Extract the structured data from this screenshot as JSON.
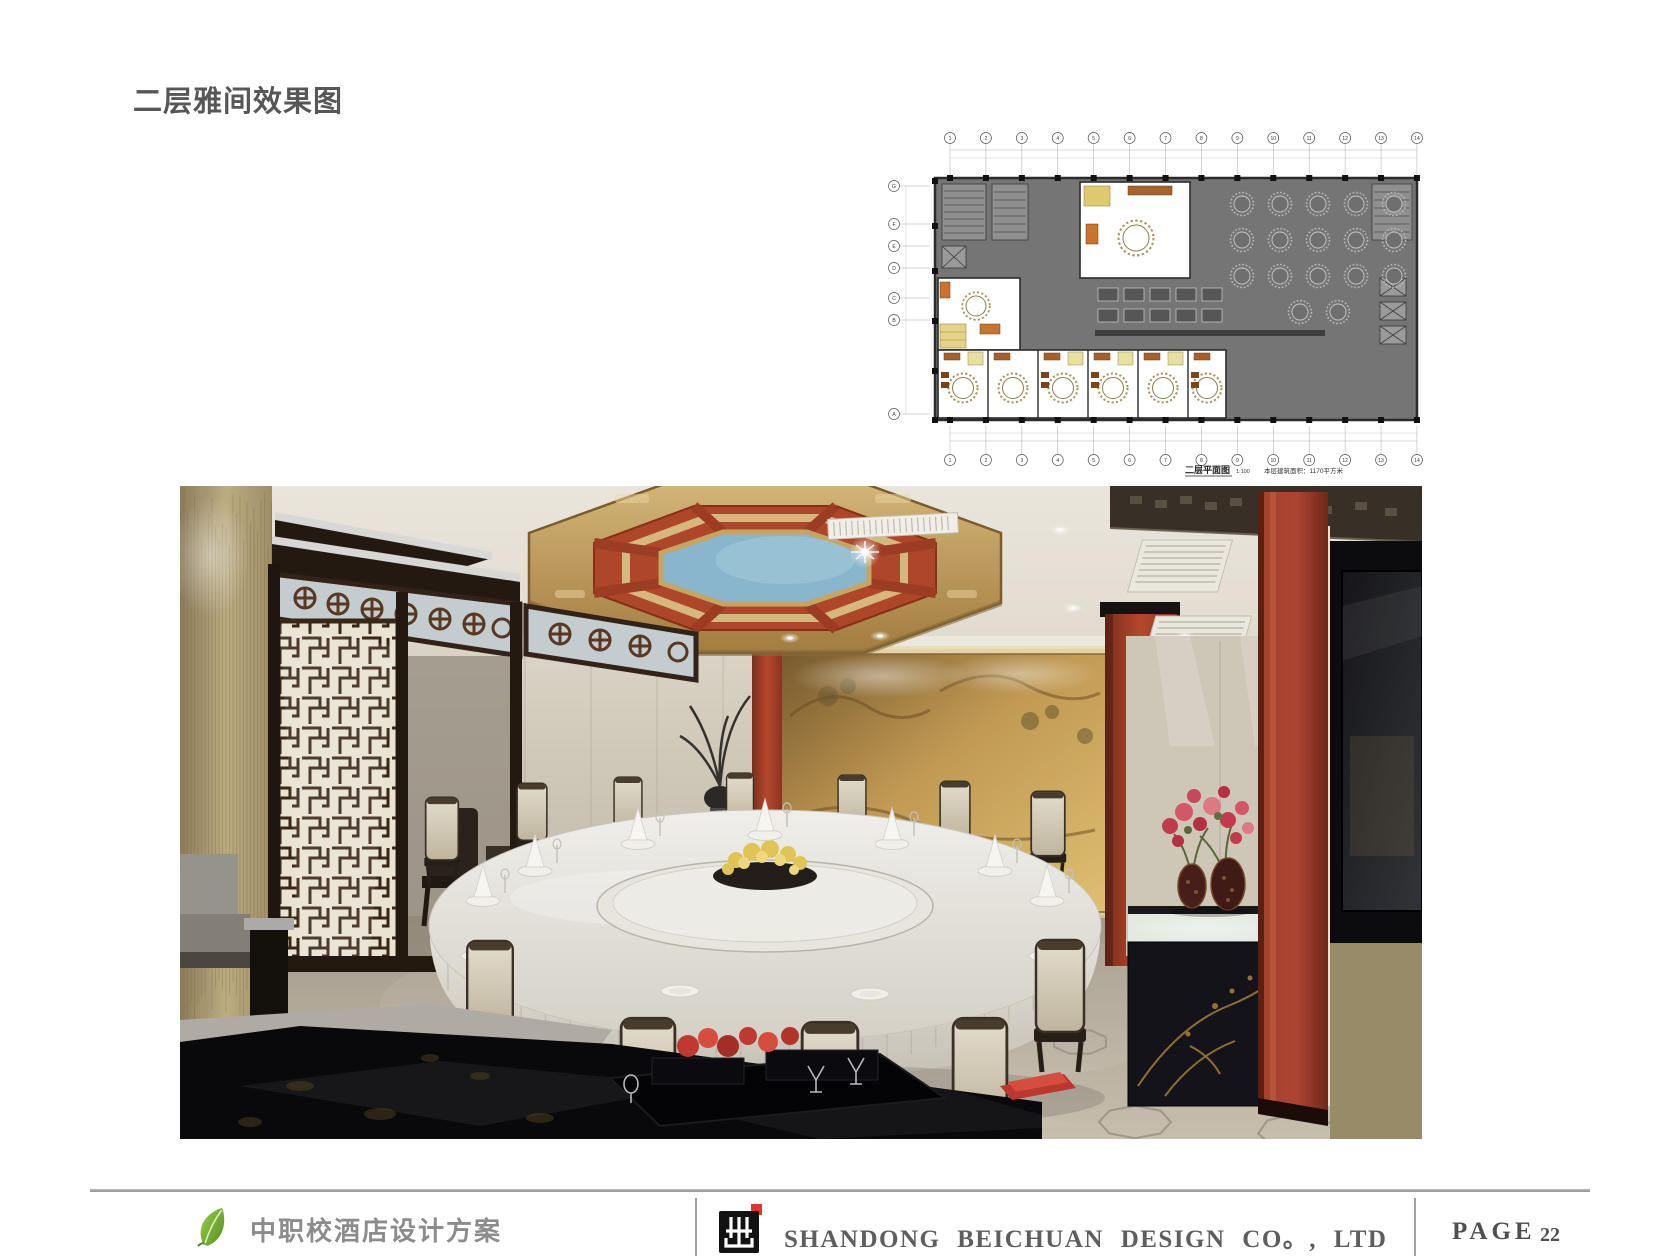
{
  "page": {
    "title": "二层雅间效果图"
  },
  "floor_plan": {
    "caption_title": "二层平面图",
    "caption_scale": "1:100",
    "caption_note": "本层建筑面积：1170平方米",
    "grid_top": [
      "1",
      "2",
      "3",
      "4",
      "5",
      "6",
      "7",
      "8",
      "9",
      "10",
      "11",
      "12",
      "13",
      "14"
    ],
    "grid_bottom": [
      "1",
      "2",
      "3",
      "4",
      "5",
      "6",
      "7",
      "8",
      "9",
      "10",
      "11",
      "12",
      "13",
      "14"
    ],
    "grid_left": [
      "G",
      "F",
      "E",
      "D",
      "C",
      "B",
      "A"
    ]
  },
  "footer": {
    "project_name": "中职校酒店设计方案",
    "company_name": "SHANDONG BEICHUAN DESIGN CO。, LTD",
    "page_label": "PAGE",
    "page_number": "22",
    "accent_red": "#e1342a",
    "leaf_green": "#6fae3a"
  }
}
